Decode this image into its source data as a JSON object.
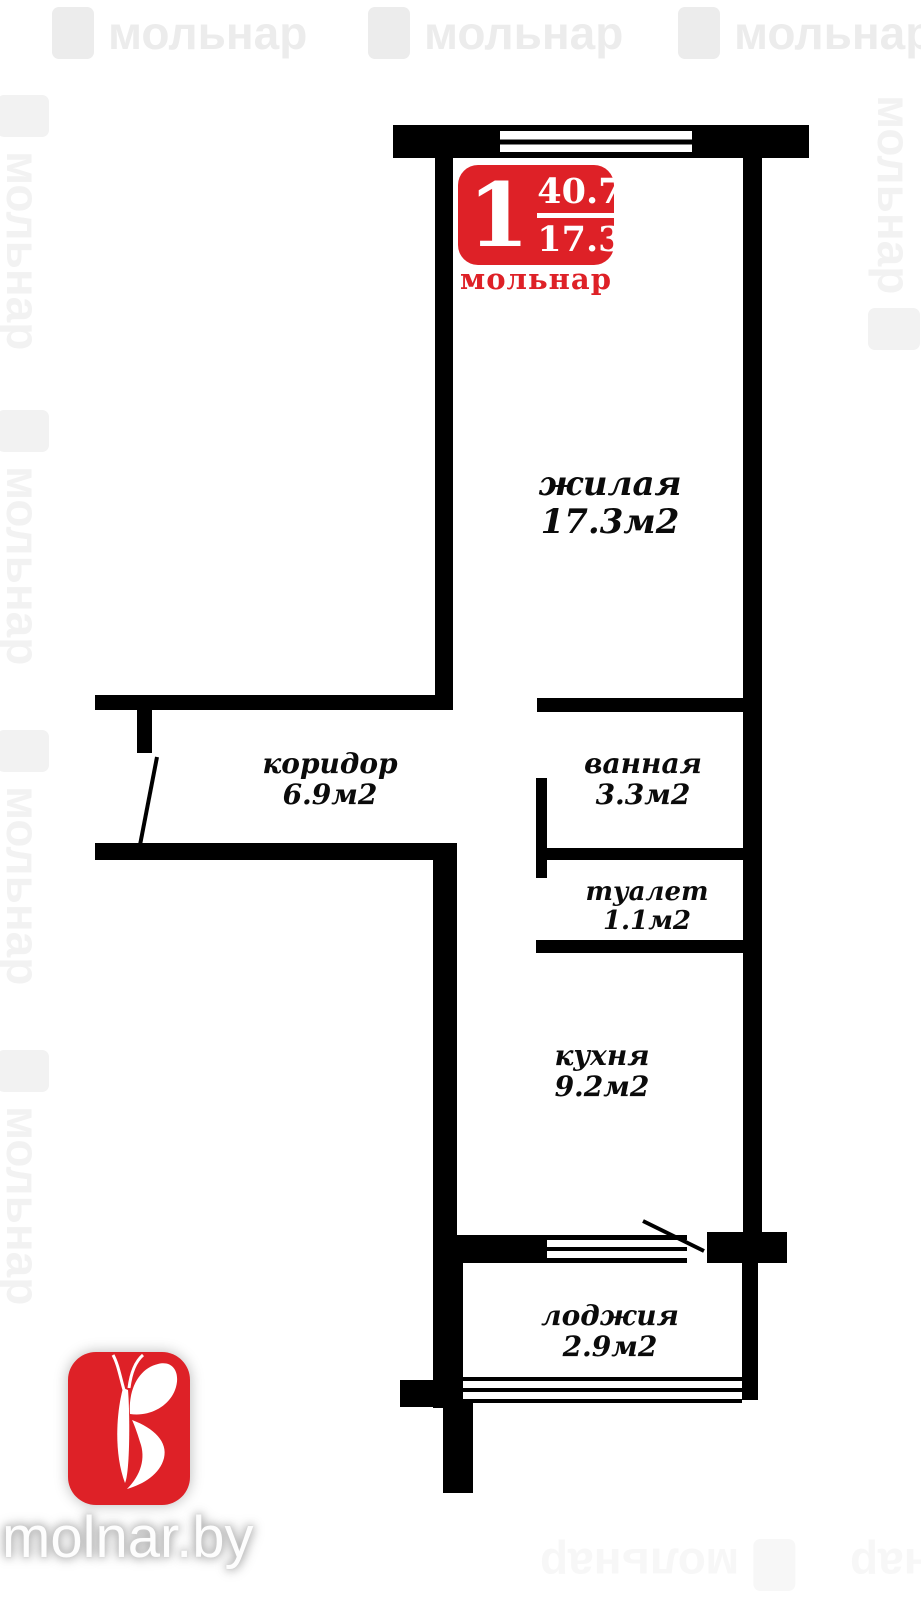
{
  "colors": {
    "brand_red": "#de2127",
    "wall_black": "#000000",
    "watermark_gray": "#ececec"
  },
  "badge": {
    "rooms_count": "1",
    "total_area": "40.7",
    "living_area": "17.3",
    "brand": "мольнар"
  },
  "rooms": [
    {
      "name": "жилая",
      "area": "17.3м2"
    },
    {
      "name": "коридор",
      "area": "6.9м2"
    },
    {
      "name": "ванная",
      "area": "3.3м2"
    },
    {
      "name": "туалет",
      "area": "1.1м2"
    },
    {
      "name": "кухня",
      "area": "9.2м2"
    },
    {
      "name": "лоджия",
      "area": "2.9м2"
    }
  ],
  "watermark": {
    "text": "мольнар"
  },
  "footer": {
    "site": "molnar.by"
  }
}
